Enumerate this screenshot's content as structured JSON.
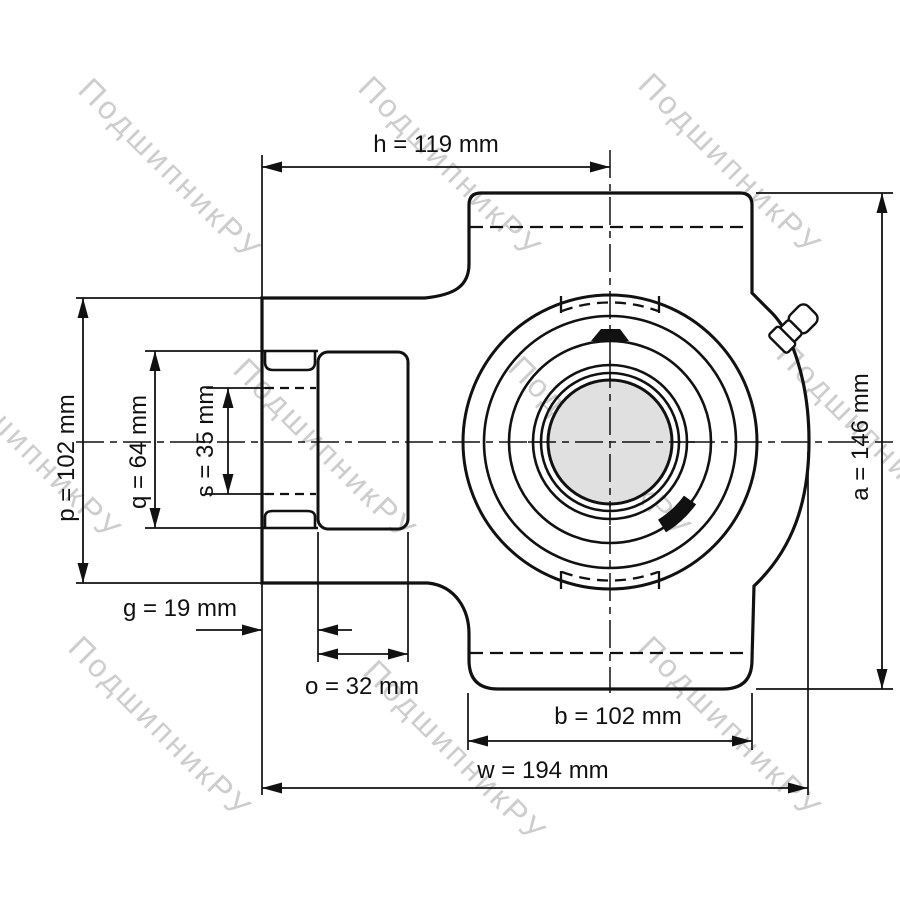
{
  "watermark": {
    "text": "ПодшипникРУ",
    "color": "#cdcdcd"
  },
  "drawing": {
    "type": "bearing take-up unit engineering drawing, front view",
    "line_color": "#111111",
    "bore_fill": "#e0e0e0",
    "dimensions": {
      "h": {
        "label": "h = 119 mm",
        "value_mm": 119
      },
      "p": {
        "label": "p = 102 mm",
        "value_mm": 102
      },
      "q": {
        "label": "q = 64 mm",
        "value_mm": 64
      },
      "s": {
        "label": "s = 35 mm",
        "value_mm": 35
      },
      "g": {
        "label": "g = 19 mm",
        "value_mm": 19
      },
      "o": {
        "label": "o = 32 mm",
        "value_mm": 32
      },
      "b": {
        "label": "b = 102 mm",
        "value_mm": 102
      },
      "w": {
        "label": "w = 194 mm",
        "value_mm": 194
      },
      "a": {
        "label": "a = 146 mm",
        "value_mm": 146
      }
    }
  }
}
